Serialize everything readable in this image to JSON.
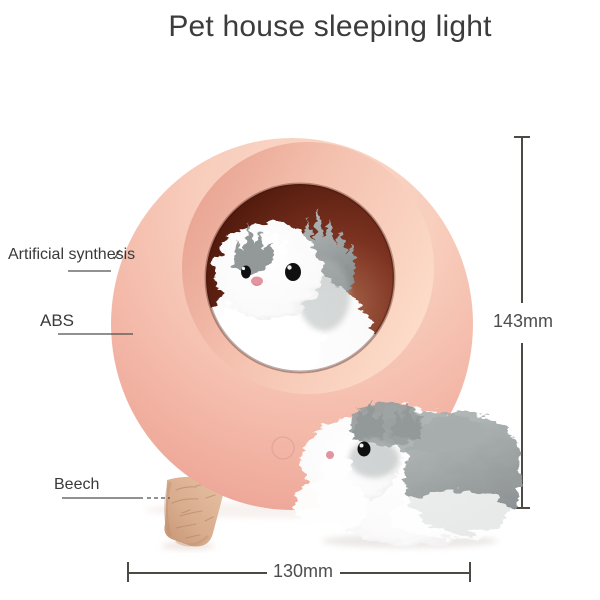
{
  "title": "Pet house sleeping light",
  "annotations": {
    "material_shell": "Artificial synthesis",
    "material_body": "ABS",
    "material_leg": "Beech"
  },
  "dimensions": {
    "height": "143mm",
    "width": "130mm"
  },
  "colors": {
    "dimension_line": "#4c4a44",
    "label_line": "#4f4f4f",
    "title_text": "#3c3c3c",
    "sphere_pink": "#f5c0af",
    "interior_maroon": "#5c1f12",
    "rim_pink": "#f4c0ae",
    "wood_beech": "#d8ac8d",
    "fur_gray": "#939999",
    "fur_white": "#ffffff",
    "eye_black": "#101010",
    "nose_pink": "#e493a0",
    "button_outline": "#dca08e"
  }
}
